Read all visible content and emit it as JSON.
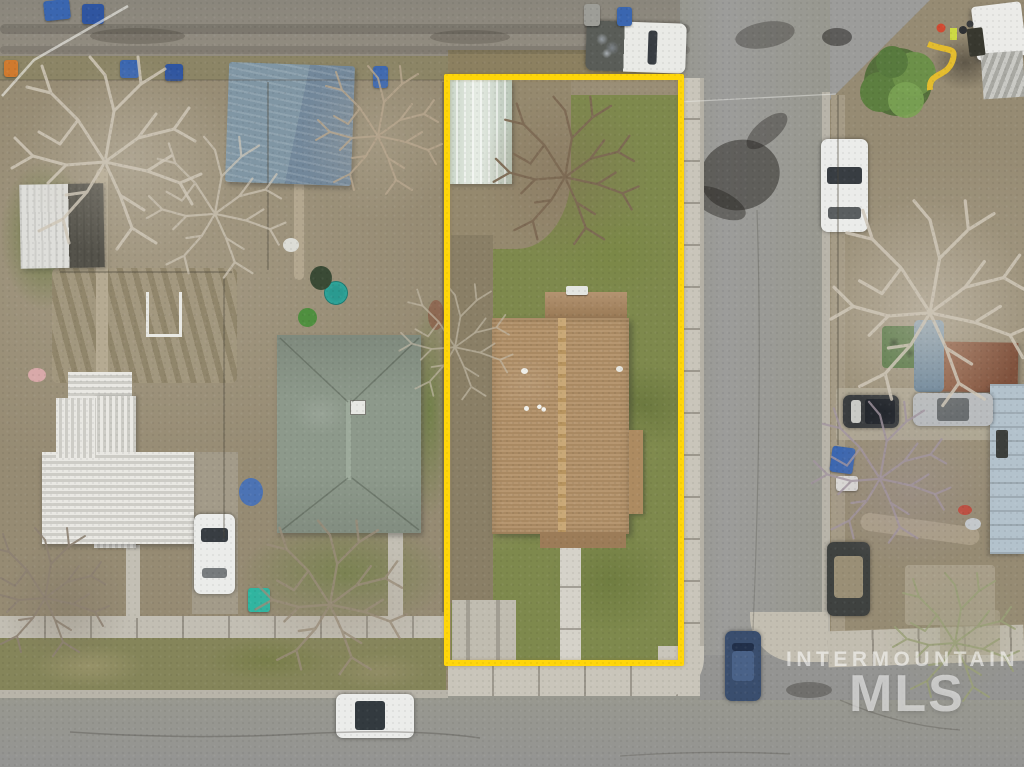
{
  "image_type": "top-down aerial drone photo of a residential block (real estate listing)",
  "watermark": {
    "line1": "INTERMOUNTAIN",
    "line2": "MLS"
  },
  "property_outline": {
    "label": "yellow property boundary around narrow lot",
    "color": "#ffd60a"
  },
  "palette": {
    "scrub": "#968b73",
    "alley": "#8f8b81",
    "asphalt": "#9c9c9a",
    "asphalt2": "#949492",
    "sidewalk": "#c9c5ba",
    "curb": "#b4b0a5",
    "gutter": "#b8b4a9",
    "grass": "#7e894d",
    "grass-light": "#96a05e",
    "grass-dark": "#5f6b3a",
    "parkstrip": "#85855a",
    "dirt": "#95896e",
    "dirt-gray": "#8a7f66",
    "gravel": "#b0a78f",
    "outline": "#ffd60a",
    "roof-brown": "#b29067",
    "roof-brown-dark": "#9c7c58",
    "roof-ridge": "#c9a877",
    "roof-sage": "#8d998b",
    "roof-white": "#e6e5e0",
    "shed-blue": "#7e94a2",
    "shed-rust": "#9c6b50",
    "greenhouse": "#ccd8c9",
    "house-blue": "#b3c2cc",
    "tree-white": "#cfc7b8",
    "tree-brown": "#7d6a54",
    "tree-purple": "#a295a0",
    "tree-tan": "#b7a68e",
    "car-white": "#ebecea",
    "car-blue": "#3a4e6e",
    "car-silver": "#b9bcbe",
    "car-dark": "#3f4240",
    "bin-blue": "#3a66b0",
    "bin-orange": "#d07a2e",
    "pool-teal": "#35b3a6",
    "tarp-blue": "#3f6ec0",
    "shadow": "rgba(35,33,30,0.5)",
    "watermark": "rgba(255,255,255,0.55)"
  },
  "scene": {
    "streets": [
      "gravel alley along top",
      "asphalt street on right with west sidewalk",
      "asphalt street along bottom"
    ],
    "outlined_lot": [
      "tan shingle-roof house with front walkway",
      "pale greenhouse-roof shed NW corner",
      "large bare tree",
      "lawn and dirt yard",
      "parking pad SW corner"
    ],
    "vehicles": [
      {
        "name": "white work van",
        "location": "alley, top center"
      },
      {
        "name": "white car",
        "location": "right street, upper"
      },
      {
        "name": "dark SUV",
        "location": "right street, lower"
      },
      {
        "name": "blue car",
        "location": "bottom-right corner"
      },
      {
        "name": "white car",
        "location": "bottom street"
      },
      {
        "name": "white car",
        "location": "left neighbor driveway"
      },
      {
        "name": "black pickup",
        "location": "right-side yard"
      },
      {
        "name": "silver sedan",
        "location": "right-side yard"
      }
    ],
    "buildings": [
      {
        "name": "slate-blue shed",
        "location": "left of lot, top"
      },
      {
        "name": "sage hip-roof house",
        "location": "left neighbor"
      },
      {
        "name": "white metal-roof house",
        "location": "far left"
      },
      {
        "name": "white shed with dark slats",
        "location": "upper far left"
      },
      {
        "name": "rust-roof shed",
        "location": "right yard"
      },
      {
        "name": "light-blue house",
        "location": "far right edge"
      },
      {
        "name": "white box truck",
        "location": "top right"
      }
    ],
    "details": [
      "blue trash bins along alley",
      "orange bin",
      "garden rows",
      "teal kiddie pool",
      "blue tarps",
      "bare winter trees",
      "green tree by right street",
      "road crew with yellow chute top right",
      "tree shadows on right street",
      "watermark bottom right"
    ]
  }
}
